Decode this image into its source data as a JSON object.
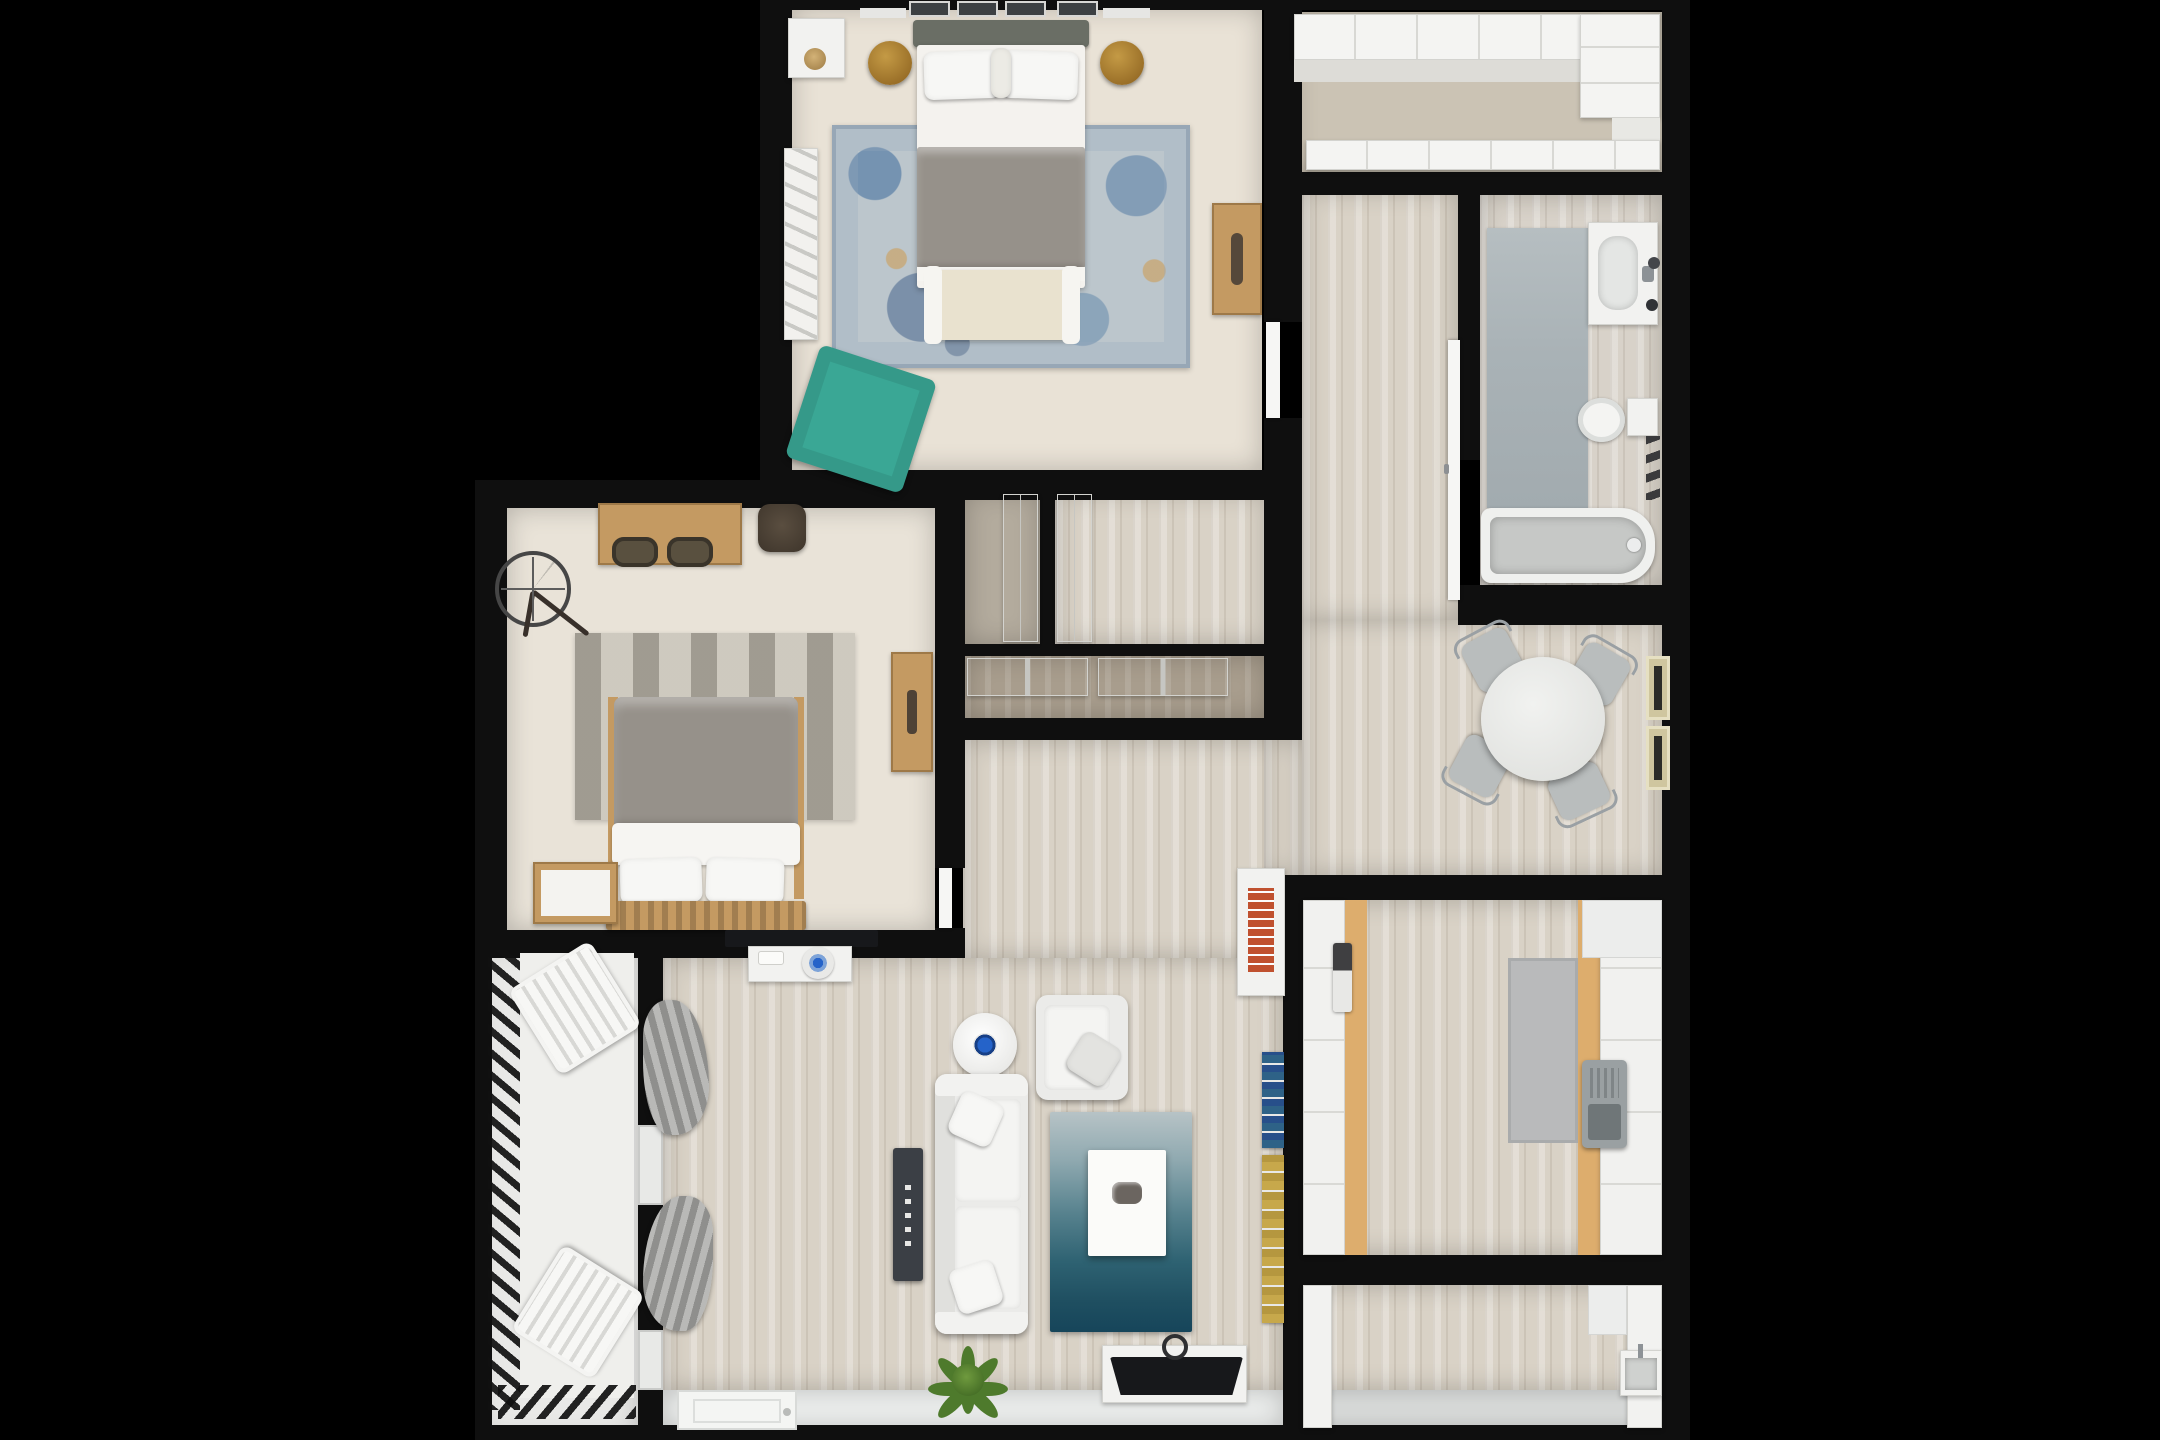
{
  "meta": {
    "kind": "3d-rendered-floor-plan",
    "view": "top-down",
    "canvas": {
      "width": 2160,
      "height": 1440
    }
  },
  "colors": {
    "bg": "#000000",
    "wall": "#0f0f0f",
    "white": "#f2f2f0",
    "carpet1": "#e9e2d6",
    "carpet2": "#e9e3d8",
    "carpetCloset": "#cbc3b4",
    "carpetDark": "#b3ab9d",
    "wood": "#d9d2c6",
    "woodDark": "#a89d8d",
    "deck": "#e9e9e7",
    "cream": "#e9e2cf",
    "duvet": "#96918a",
    "headboard": "#6a6e65",
    "teal": "#3aa795",
    "gold": "#a87c2e",
    "woodFurn": "#c49a62",
    "woodDeep": "#8a6b3f",
    "rugBase": "#bcc6cc",
    "sofa": "#ebebe9",
    "console": "#3b3f45",
    "tv": "#17181b",
    "plant": "#4e7a2c",
    "plantDark": "#39611f",
    "chairGray": "#b9bdbd",
    "chrome": "#9aa0a4",
    "matBlue": "#a9b2b6",
    "grayRug": "#b9babb",
    "tanCounter": "#ddad6d",
    "appliance": "#9aa0a2",
    "booksRed": "#c0512f",
    "booksBlue": "#2e6287",
    "booksYellow": "#c7a84b",
    "curtain": "#9c9c9a"
  },
  "rooms": [
    {
      "id": "bedroom-1",
      "floor": "beige carpet"
    },
    {
      "id": "walk-in-closet",
      "floor": "beige carpet"
    },
    {
      "id": "corridor",
      "floor": "light wood planks"
    },
    {
      "id": "bathroom",
      "floor": "light wood planks"
    },
    {
      "id": "closet-a",
      "floor": "dark carpet"
    },
    {
      "id": "closet-b",
      "floor": "light wood planks"
    },
    {
      "id": "closet-c",
      "floor": "dark wood"
    },
    {
      "id": "bedroom-2",
      "floor": "beige carpet"
    },
    {
      "id": "hallway",
      "floor": "light wood planks"
    },
    {
      "id": "dining-area",
      "floor": "light wood planks"
    },
    {
      "id": "kitchen",
      "floor": "light wood planks"
    },
    {
      "id": "laundry-room",
      "floor": "wood + gray tile"
    },
    {
      "id": "living-room",
      "floor": "light wood planks + white entry strip"
    },
    {
      "id": "balcony",
      "floor": "light gray deck"
    }
  ],
  "furniture": {
    "bedroom1": [
      "double-bed",
      "gray-duvet",
      "two-white-pillows",
      "foot-bench",
      "area-rug-blue-distressed",
      "gold-nightstand-left",
      "gold-nightstand-right",
      "wall-shelf",
      "dresser",
      "storage-bench",
      "teal-ottoman",
      "four-windows"
    ],
    "walkInCloset": [
      "cabinet-run-top",
      "cabinet-run-right",
      "cabinet-run-bottom"
    ],
    "bathroom": [
      "vanity-sink",
      "toilet",
      "bathtub",
      "runner-mat",
      "towel-hooks"
    ],
    "bedroom2": [
      "desk",
      "two-desk-chairs",
      "woven-pouf",
      "wall-clock",
      "striped-rug",
      "double-bed",
      "nightstand",
      "wood-console"
    ],
    "dining": [
      "round-table",
      "four-chairs",
      "two-wall-panels"
    ],
    "kitchen": [
      "left-counter",
      "right-counter",
      "gray-mat",
      "countertop-appliance",
      "paper-towel-holder"
    ],
    "laundry": [
      "left-cabinet",
      "right-cabinet",
      "utility-sink"
    ],
    "living": [
      "wall-tv-bar",
      "sideboard",
      "decor-plate",
      "decor-tray",
      "armchair",
      "round-side-table",
      "sofa",
      "media-console",
      "blue-gradient-rug",
      "coffee-table",
      "tv-stand",
      "television",
      "potted-plant",
      "bookshelf-red",
      "book-ledge-blue",
      "book-ledge-yellow",
      "curtains",
      "entry-door-mat"
    ],
    "balcony": [
      "lounge-chair-top",
      "lounge-chair-bottom",
      "railing"
    ]
  }
}
